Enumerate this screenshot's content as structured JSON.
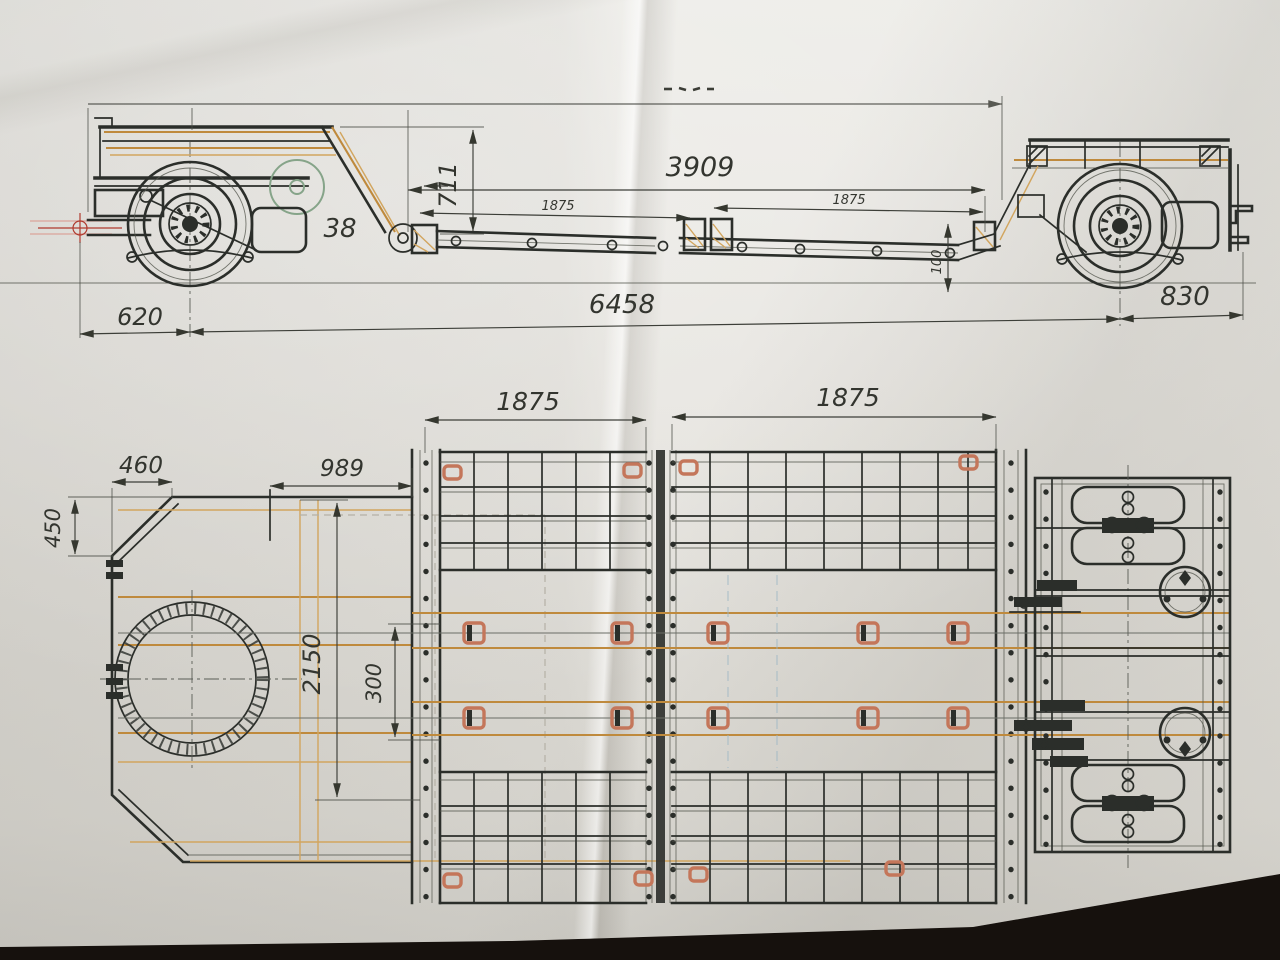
{
  "side_view": {
    "dimensions": {
      "overall_top_partial": "",
      "gooseneck_to_rear": "3909",
      "gooseneck_height": "711",
      "ramp_note": "38",
      "deck_section_left": "1875",
      "deck_section_right": "1875",
      "frame_height": "100",
      "drawbar_length": "620",
      "total_length": "6458",
      "rear_overhang": "830"
    }
  },
  "plan_view": {
    "dimensions": {
      "deck_section_left": "1875",
      "deck_section_right": "1875",
      "front_chamfer_width": "460",
      "gooseneck_section": "989",
      "front_chamfer_height": "450",
      "platform_width": "2150",
      "frame_spacing": "300"
    }
  },
  "colors": {
    "backdrop": "#16110d",
    "ink": "#2b2e2a",
    "wood": "#bf8a3d",
    "wood2": "#d2a55e",
    "hook": "#c4765a",
    "red": "#b03a2e",
    "pink": "#dba49a",
    "green": "#86a489",
    "blue": "#9cb6c4",
    "dimtext": "#33352f"
  }
}
